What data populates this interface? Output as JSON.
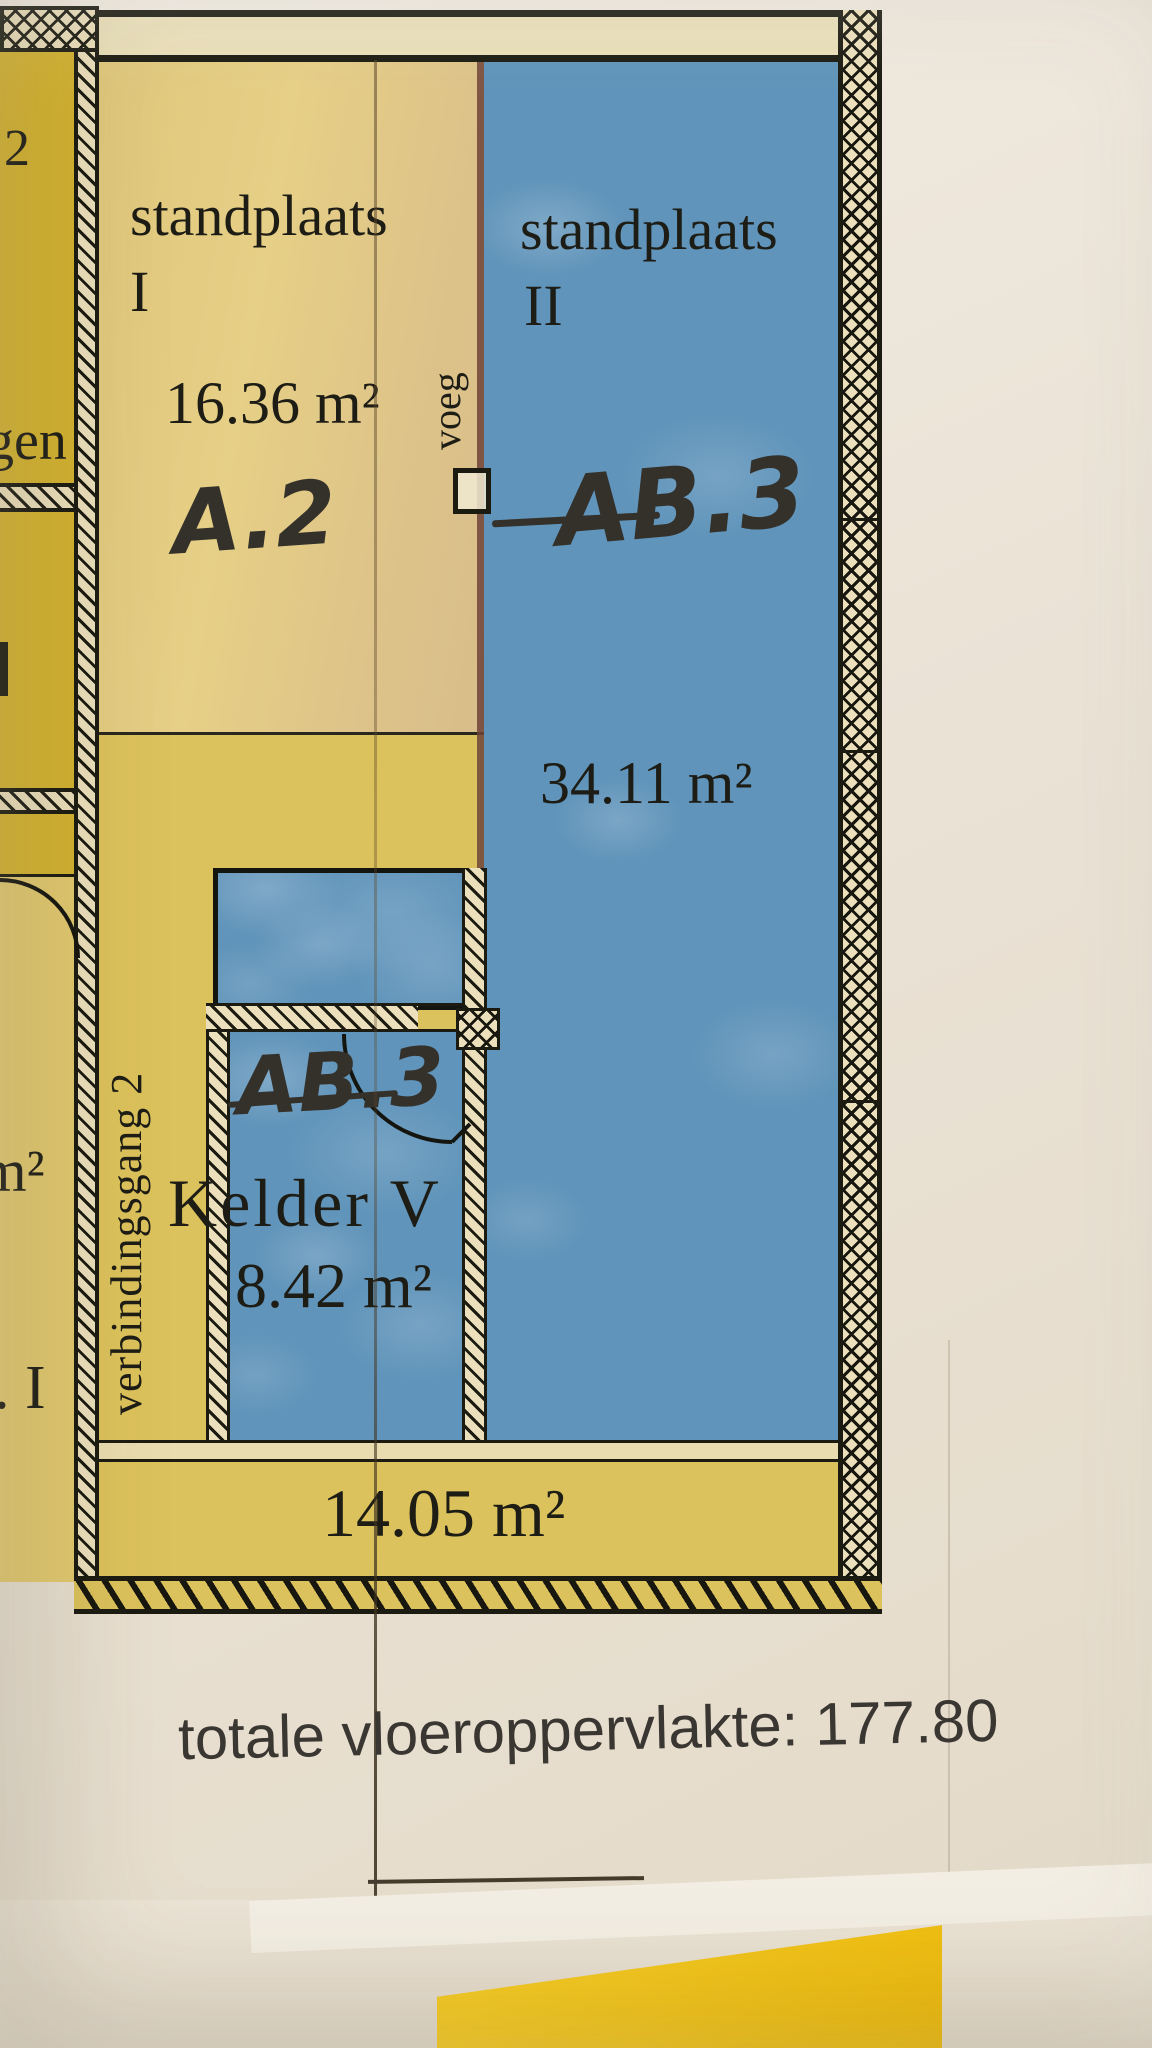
{
  "plan": {
    "standplaats_i": {
      "name": "standplaats",
      "numeral": "I",
      "area": "16.36 m²",
      "handwritten_code": "A.2"
    },
    "standplaats_ii": {
      "name": "standplaats",
      "numeral": "II",
      "area": "34.11 m²",
      "handwritten_code": "AB.3"
    },
    "kelder": {
      "handwritten_code": "AB.3",
      "name": "Kelder V",
      "area": "8.42 m²"
    },
    "corridor": {
      "name": "verbindingsgang 2"
    },
    "bottom_strip": {
      "area": "14.05 m²"
    },
    "joint": {
      "label": "voeg"
    },
    "edge_fragments": {
      "room_number": "2",
      "word_upper": "gen",
      "area_unit": "m²",
      "numeral": ". I"
    }
  },
  "footer": {
    "label": "totale vloeroppervlakte:",
    "value": "177.80",
    "text": "totale vloeroppervlakte: 177.80"
  },
  "colors": {
    "blue_fill": "#6094ba",
    "yellow_dark": "#d5b430",
    "yellow_mid": "#dcc25c",
    "tan_fill": "#e6cf86",
    "wall_ink": "#1b1b12",
    "paper": "#eae2d5",
    "marker_ink": "#34312b",
    "highlight_object": "#f6c81e"
  }
}
